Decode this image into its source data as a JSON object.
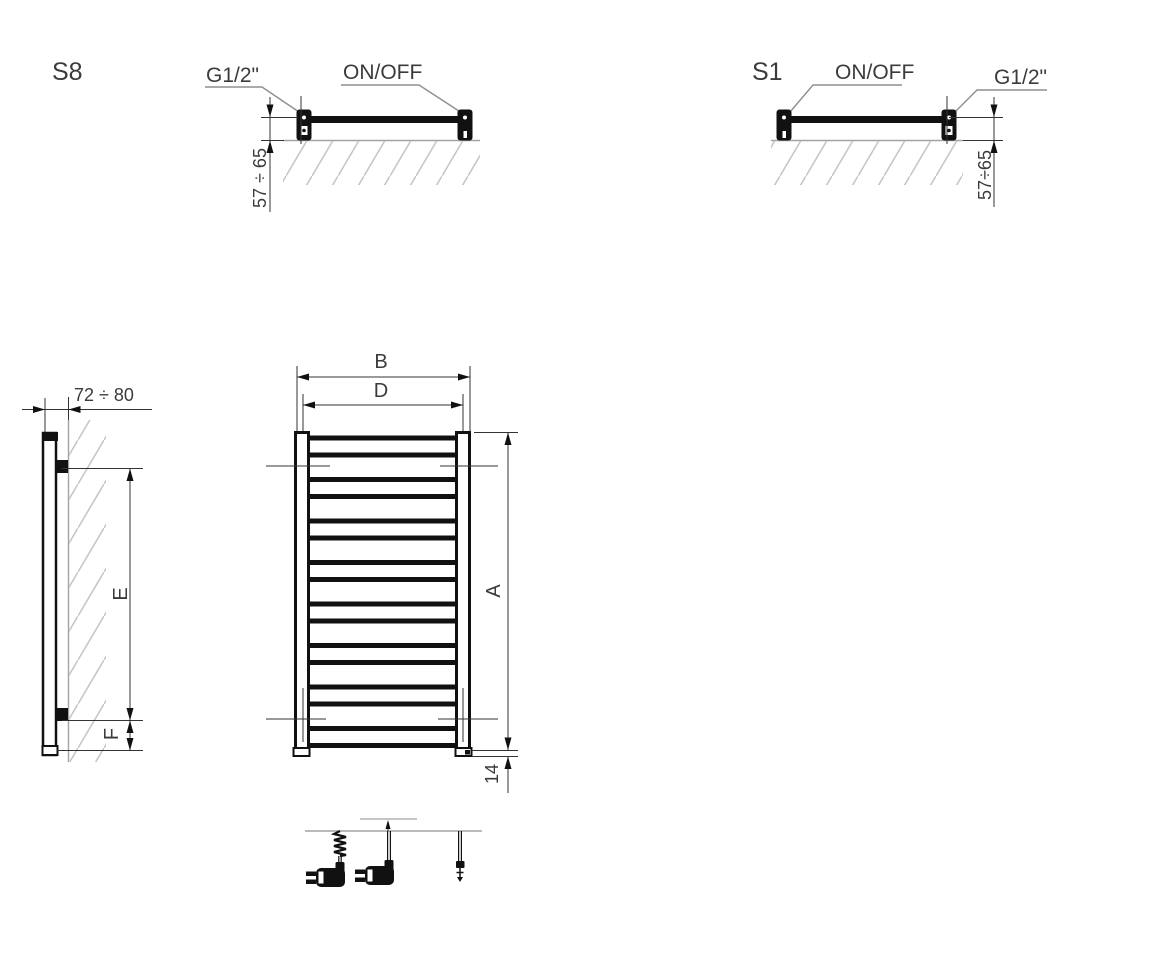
{
  "palette": {
    "drawing_line": "#111111",
    "dimension_line": "#333333",
    "wall_line": "#a3a3a3",
    "hatch": "#c6c6c6",
    "text": "#3b3b3b"
  },
  "top_view_s8": {
    "model": "S8",
    "thread": "G1/2\"",
    "switch": "ON/OFF",
    "wall_distance": "57 ÷ 65"
  },
  "top_view_s1": {
    "model": "S1",
    "switch": "ON/OFF",
    "thread": "G1/2\"",
    "wall_distance": "57÷65"
  },
  "side_view": {
    "wall_offset": "72 ÷ 80",
    "bracket_span": "E",
    "bottom_span": "F"
  },
  "front_view": {
    "width_overall": "B",
    "width_connections": "D",
    "height_overall": "A",
    "foot_offset": "14"
  },
  "cable_options": {
    "coiled": "spiral-cable-with-plug",
    "straight": "straight-cable-with-plug",
    "bare": "bare-wire-cable"
  }
}
